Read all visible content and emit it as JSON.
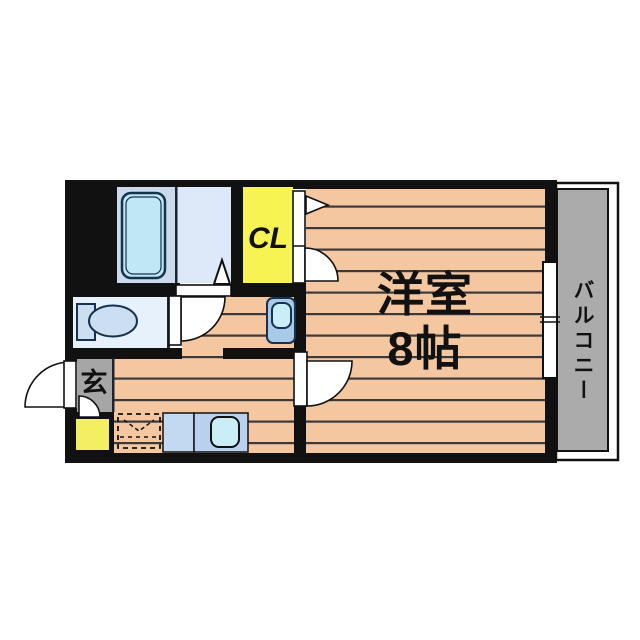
{
  "floorplan": {
    "labels": {
      "main_room": "洋室",
      "main_room_size": "8帖",
      "closet": "CL",
      "entrance": "玄",
      "balcony": "バルコニー"
    },
    "colors": {
      "wall": "#111111",
      "floor": "#f4c7a0",
      "floorline": "#3a3a3a",
      "closet": "#f6f353",
      "balcony": "#ababab",
      "genkan": "#a6a6a6",
      "bath": "#cbdaec",
      "wash": "#dde9f8",
      "toilet": "#e7f1fc",
      "fixture": "#ccdff2",
      "tub": "#bfe7f4",
      "sink": "#c9eef8",
      "basin": "#a9c9e9",
      "counter": "#c3d9f1",
      "counter2": "#b9d0ee",
      "shoebox": "#f2ef62",
      "outline": "#16324f"
    }
  }
}
